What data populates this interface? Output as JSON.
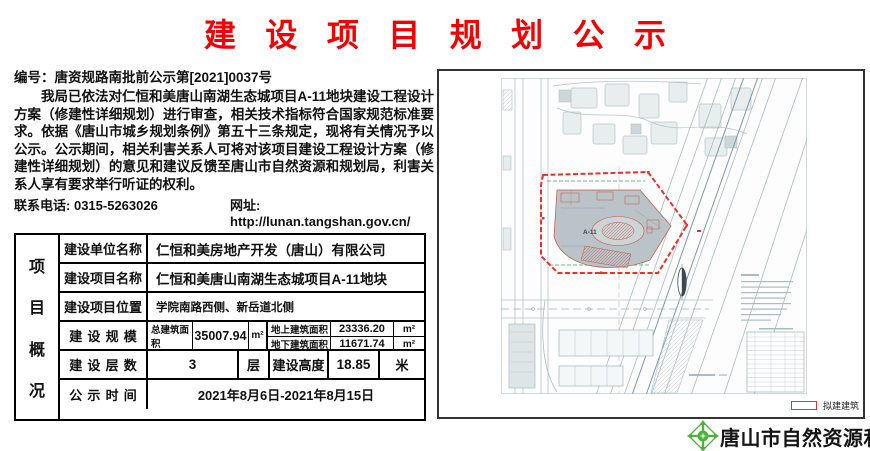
{
  "title": "建设项目规划公示",
  "doc_number": "编号：唐资规路南批前公示第[2021]0037号",
  "body_paragraph": "我局已依法对仁恒和美唐山南湖生态城项目A-11地块建设工程设计方案（修建性详细规划）进行审查，相关技术指标符合国家规范标准要求。依据《唐山市城乡规划条例》第五十三条规定，现将有关情况予以公示。公示期间，相关利害关系人可将对该项目建设工程设计方案（修建性详细规划）的意见和建议反馈至唐山市自然资源和规划局，利害关系人享有要求举行听证的权利。",
  "contact": {
    "phone_label": "联系电话:",
    "phone": "0315-5263026",
    "site_label": "网址:",
    "site": "http://lunan.tangshan.gov.cn/"
  },
  "table": {
    "section_chars": [
      "项",
      "目",
      "概",
      "况"
    ],
    "unit_row": {
      "label": "建设单位名称",
      "value": "仁恒和美房地产开发（唐山）有限公司"
    },
    "project_row": {
      "label": "建设项目名称",
      "value": "仁恒和美唐山南湖生态城项目A-11地块"
    },
    "location_row": {
      "label": "建设项目位置",
      "value": "学院南路西侧、新岳道北侧"
    },
    "scale_row": {
      "label": "建设规模",
      "total_label": "总建筑面积",
      "total_value": "35007.94",
      "total_unit": "m²",
      "above_label": "地上建筑面积",
      "above_value": "23336.20",
      "above_unit": "m²",
      "below_label": "地下建筑面积",
      "below_value": "11671.74",
      "below_unit": "m²"
    },
    "floors_row": {
      "label": "建设层数",
      "value": "3",
      "unit": "层",
      "height_label": "建设高度",
      "height_value": "18.85",
      "height_unit": "米"
    },
    "period_row": {
      "label": "公示时间",
      "value": "2021年8月6日-2021年8月15日"
    }
  },
  "map": {
    "site_label": "A-11",
    "legend_label": "拟建建筑"
  },
  "footer": {
    "agency": "唐山市自然资源和规划局"
  },
  "colors": {
    "title_red": "#f20000",
    "boundary_red": "#e8322a",
    "building_gray": "#b9c3c8",
    "logo_green": "#4db33d"
  }
}
